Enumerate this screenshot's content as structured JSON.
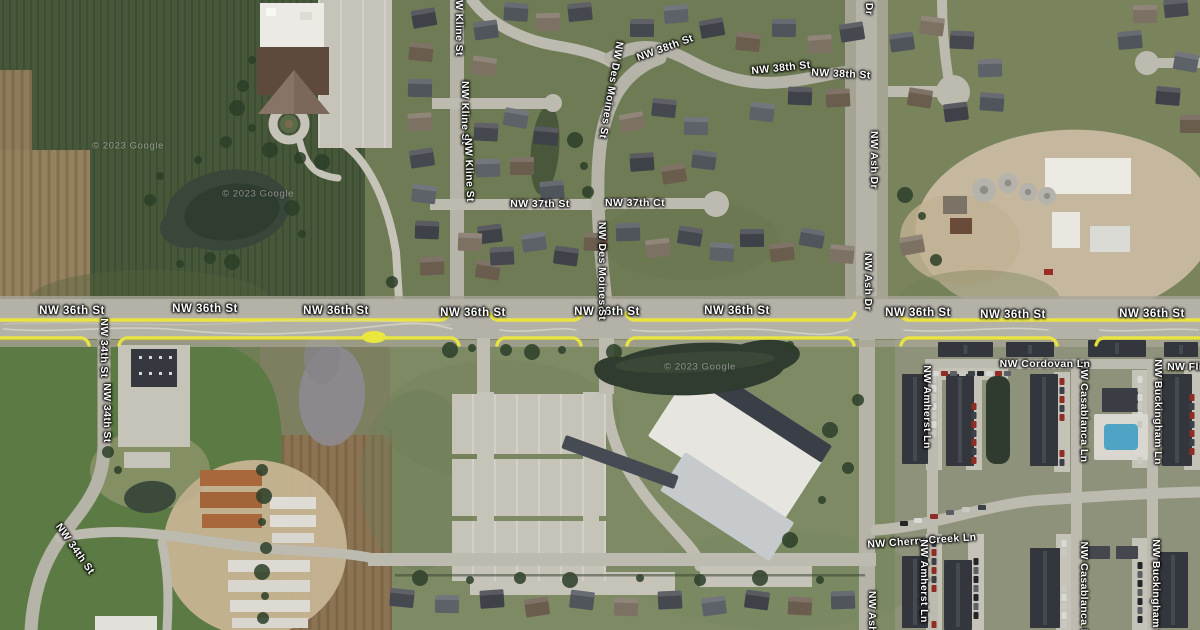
{
  "map": {
    "view": "satellite",
    "highlighted_street": "NW 36th St",
    "highlight_color": "#ece73c",
    "attribution": "© 2023 Google"
  },
  "street_labels": [
    {
      "text": "NW 36th St",
      "x": 72,
      "y": 311,
      "rot": 0,
      "main": true
    },
    {
      "text": "NW 36th St",
      "x": 205,
      "y": 309,
      "rot": 0,
      "main": true
    },
    {
      "text": "NW 36th St",
      "x": 336,
      "y": 311,
      "rot": 0,
      "main": true
    },
    {
      "text": "NW 36th St",
      "x": 473,
      "y": 313,
      "rot": 0,
      "main": true
    },
    {
      "text": "NW 36th St",
      "x": 607,
      "y": 312,
      "rot": 0,
      "main": true
    },
    {
      "text": "NW 36th St",
      "x": 737,
      "y": 311,
      "rot": 0,
      "main": true
    },
    {
      "text": "NW 36th St",
      "x": 918,
      "y": 313,
      "rot": 0,
      "main": true
    },
    {
      "text": "NW 36th St",
      "x": 1013,
      "y": 315,
      "rot": 0,
      "main": true
    },
    {
      "text": "NW 36th St",
      "x": 1152,
      "y": 314,
      "rot": 0,
      "main": true
    },
    {
      "text": "NW 34th St",
      "x": 104,
      "y": 348,
      "rot": 90
    },
    {
      "text": "NW 34th St",
      "x": 107,
      "y": 413,
      "rot": 90
    },
    {
      "text": "NW 34th St",
      "x": 75,
      "y": 549,
      "rot": 55
    },
    {
      "text": "NW Kline St",
      "x": 459,
      "y": 24,
      "rot": 90
    },
    {
      "text": "NW Kline St",
      "x": 465,
      "y": 113,
      "rot": 90
    },
    {
      "text": "NW Kline St",
      "x": 469,
      "y": 170,
      "rot": 88
    },
    {
      "text": "NW Des Moines St",
      "x": 611,
      "y": 90,
      "rot": 100
    },
    {
      "text": "NW Des Moines St",
      "x": 602,
      "y": 271,
      "rot": 90
    },
    {
      "text": "NW 37th St",
      "x": 540,
      "y": 204,
      "rot": 0
    },
    {
      "text": "NW 37th Ct",
      "x": 635,
      "y": 203,
      "rot": 0
    },
    {
      "text": "NW 38th St",
      "x": 665,
      "y": 48,
      "rot": -20
    },
    {
      "text": "NW 38th St",
      "x": 781,
      "y": 68,
      "rot": -6
    },
    {
      "text": "NW 38th St",
      "x": 841,
      "y": 74,
      "rot": 3
    },
    {
      "text": "Dr",
      "x": 869,
      "y": 9,
      "rot": 90
    },
    {
      "text": "NW Ash Dr",
      "x": 874,
      "y": 160,
      "rot": 90
    },
    {
      "text": "NW Ash Dr",
      "x": 868,
      "y": 282,
      "rot": 90
    },
    {
      "text": "NW Ash",
      "x": 872,
      "y": 612,
      "rot": 90
    },
    {
      "text": "NW Cherry Creek Ln",
      "x": 922,
      "y": 541,
      "rot": -4
    },
    {
      "text": "NW Amherst Ln",
      "x": 927,
      "y": 407,
      "rot": 90
    },
    {
      "text": "NW Amherst Ln",
      "x": 924,
      "y": 581,
      "rot": 90
    },
    {
      "text": "NW Casablanca Ln",
      "x": 1084,
      "y": 412,
      "rot": 90
    },
    {
      "text": "NW Casablanca Ln",
      "x": 1084,
      "y": 592,
      "rot": 90
    },
    {
      "text": "NW Buckingham Ln",
      "x": 1158,
      "y": 412,
      "rot": 90
    },
    {
      "text": "NW Buckingham Ln",
      "x": 1156,
      "y": 592,
      "rot": 90
    },
    {
      "text": "NW Cordovan Ln",
      "x": 1045,
      "y": 364,
      "rot": 0
    },
    {
      "text": "NW Flin",
      "x": 1188,
      "y": 367,
      "rot": 0
    }
  ],
  "watermarks": [
    {
      "text": "© 2023 Google",
      "x": 128,
      "y": 146
    },
    {
      "text": "© 2023 Google",
      "x": 258,
      "y": 194
    },
    {
      "text": "© 2023 Google",
      "x": 700,
      "y": 367
    }
  ]
}
